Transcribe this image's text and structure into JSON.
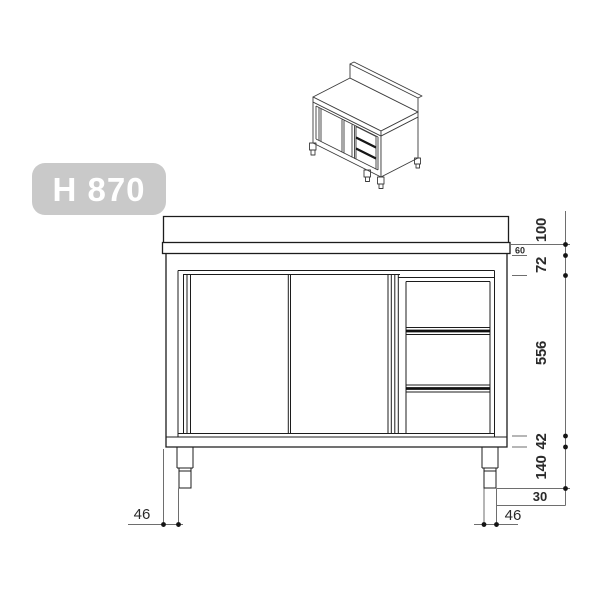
{
  "badge": {
    "label": "H 870"
  },
  "dimensions": {
    "upstand_height": "100",
    "worktop_thickness": "60",
    "top_rail_height": "72",
    "front_opening_height": "556",
    "bottom_rail_height": "42",
    "leg_height": "140",
    "leg_inset_right": "30",
    "right_foot_width": "46",
    "leg_inset_left": "46"
  },
  "colors": {
    "badge_background": "#c9c9c9",
    "drawing_line": "#1c1c1c",
    "dimension_line": "#6e6e6e"
  }
}
